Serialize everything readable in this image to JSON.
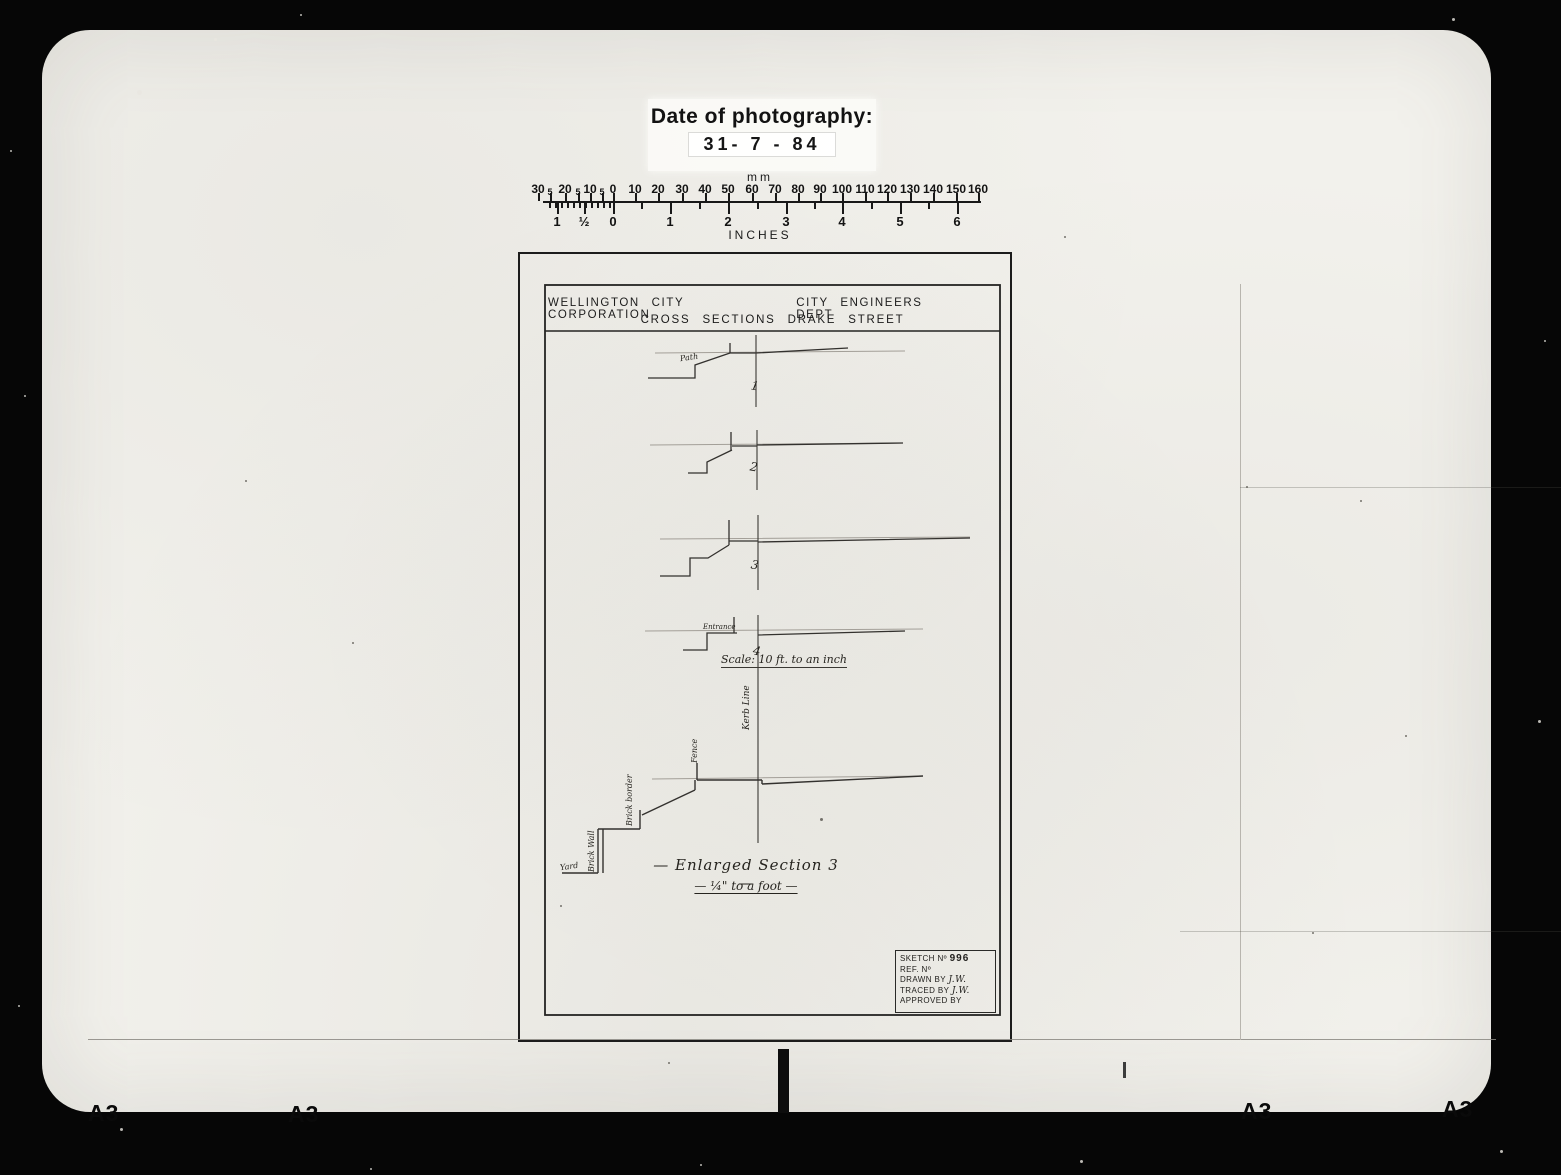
{
  "photo_label": {
    "title": "Date of photography:",
    "date": "31- 7 - 84"
  },
  "ruler": {
    "top_unit": "mm",
    "bottom_unit": "INCHES",
    "mm_labels": [
      "30",
      "5",
      "20",
      "5",
      "10",
      "5",
      "0",
      "10",
      "20",
      "30",
      "40",
      "50",
      "60",
      "70",
      "80",
      "90",
      "100",
      "110",
      "120",
      "130",
      "140",
      "150",
      "160"
    ],
    "inch_labels": [
      "1",
      "½",
      "0",
      "1",
      "2",
      "3",
      "4",
      "5",
      "6"
    ]
  },
  "drawing": {
    "org": "WELLINGTON CITY CORPORATION",
    "dept": "CITY ENGINEERS DEPT",
    "title": "CROSS SECTIONS DRAKE STREET",
    "section_numbers": [
      "1",
      "2",
      "3",
      "4"
    ],
    "annotations": {
      "path": "Path",
      "entrance": "Entrance",
      "kerb_line": "Kerb Line",
      "fence": "Fence",
      "brick_border": "Brick border",
      "brick_wall": "Brick Wall",
      "yard": "Yard"
    },
    "scale_note": "Scale: 10 ft. to an inch",
    "enlarged_title": "— Enlarged Section 3 —",
    "enlarged_scale": "— ¼\" to a foot —",
    "info_box": {
      "sketch_label": "SKETCH Nº",
      "sketch_no": "996",
      "ref_label": "REF. Nº",
      "drawn_label": "DRAWN BY",
      "drawn_by": "J.W.",
      "traced_label": "TRACED BY",
      "traced_by": "J.W.",
      "approved_label": "APPROVED BY"
    }
  },
  "film": {
    "edge_labels": [
      "A3",
      "A3",
      "A3",
      "A3"
    ]
  }
}
